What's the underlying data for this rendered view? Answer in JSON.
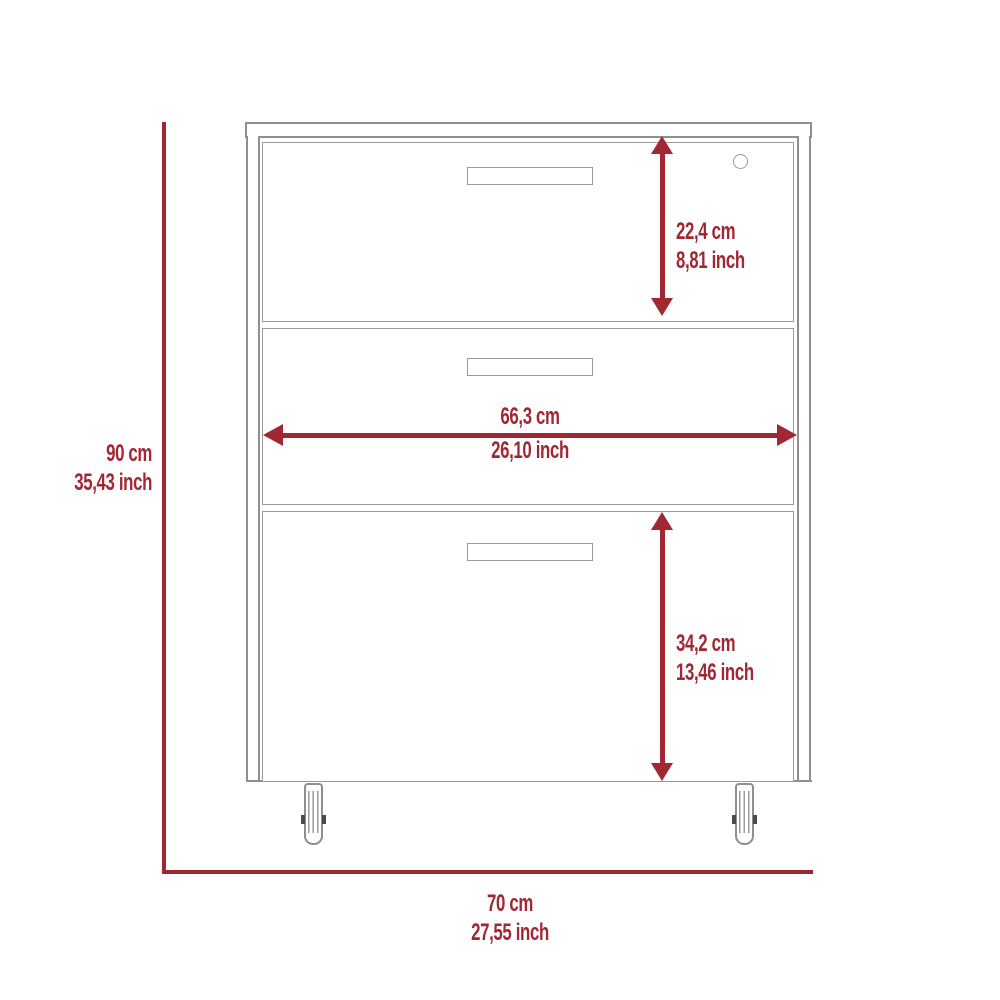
{
  "colors": {
    "dimension_red": "#a12833",
    "line_art_gray": "#8f8f8f",
    "background": "#ffffff"
  },
  "dimensions": {
    "overall_height": {
      "cm": "90 cm",
      "inch": "35,43 inch"
    },
    "overall_width": {
      "cm": "70 cm",
      "inch": "27,55 inch"
    },
    "top_drawer_height": {
      "cm": "22,4 cm",
      "inch": "8,81 inch"
    },
    "drawer_inner_width": {
      "cm": "66,3 cm",
      "inch": "26,10 inch"
    },
    "bottom_drawer_height": {
      "cm": "34,2 cm",
      "inch": "13,46 inch"
    }
  }
}
